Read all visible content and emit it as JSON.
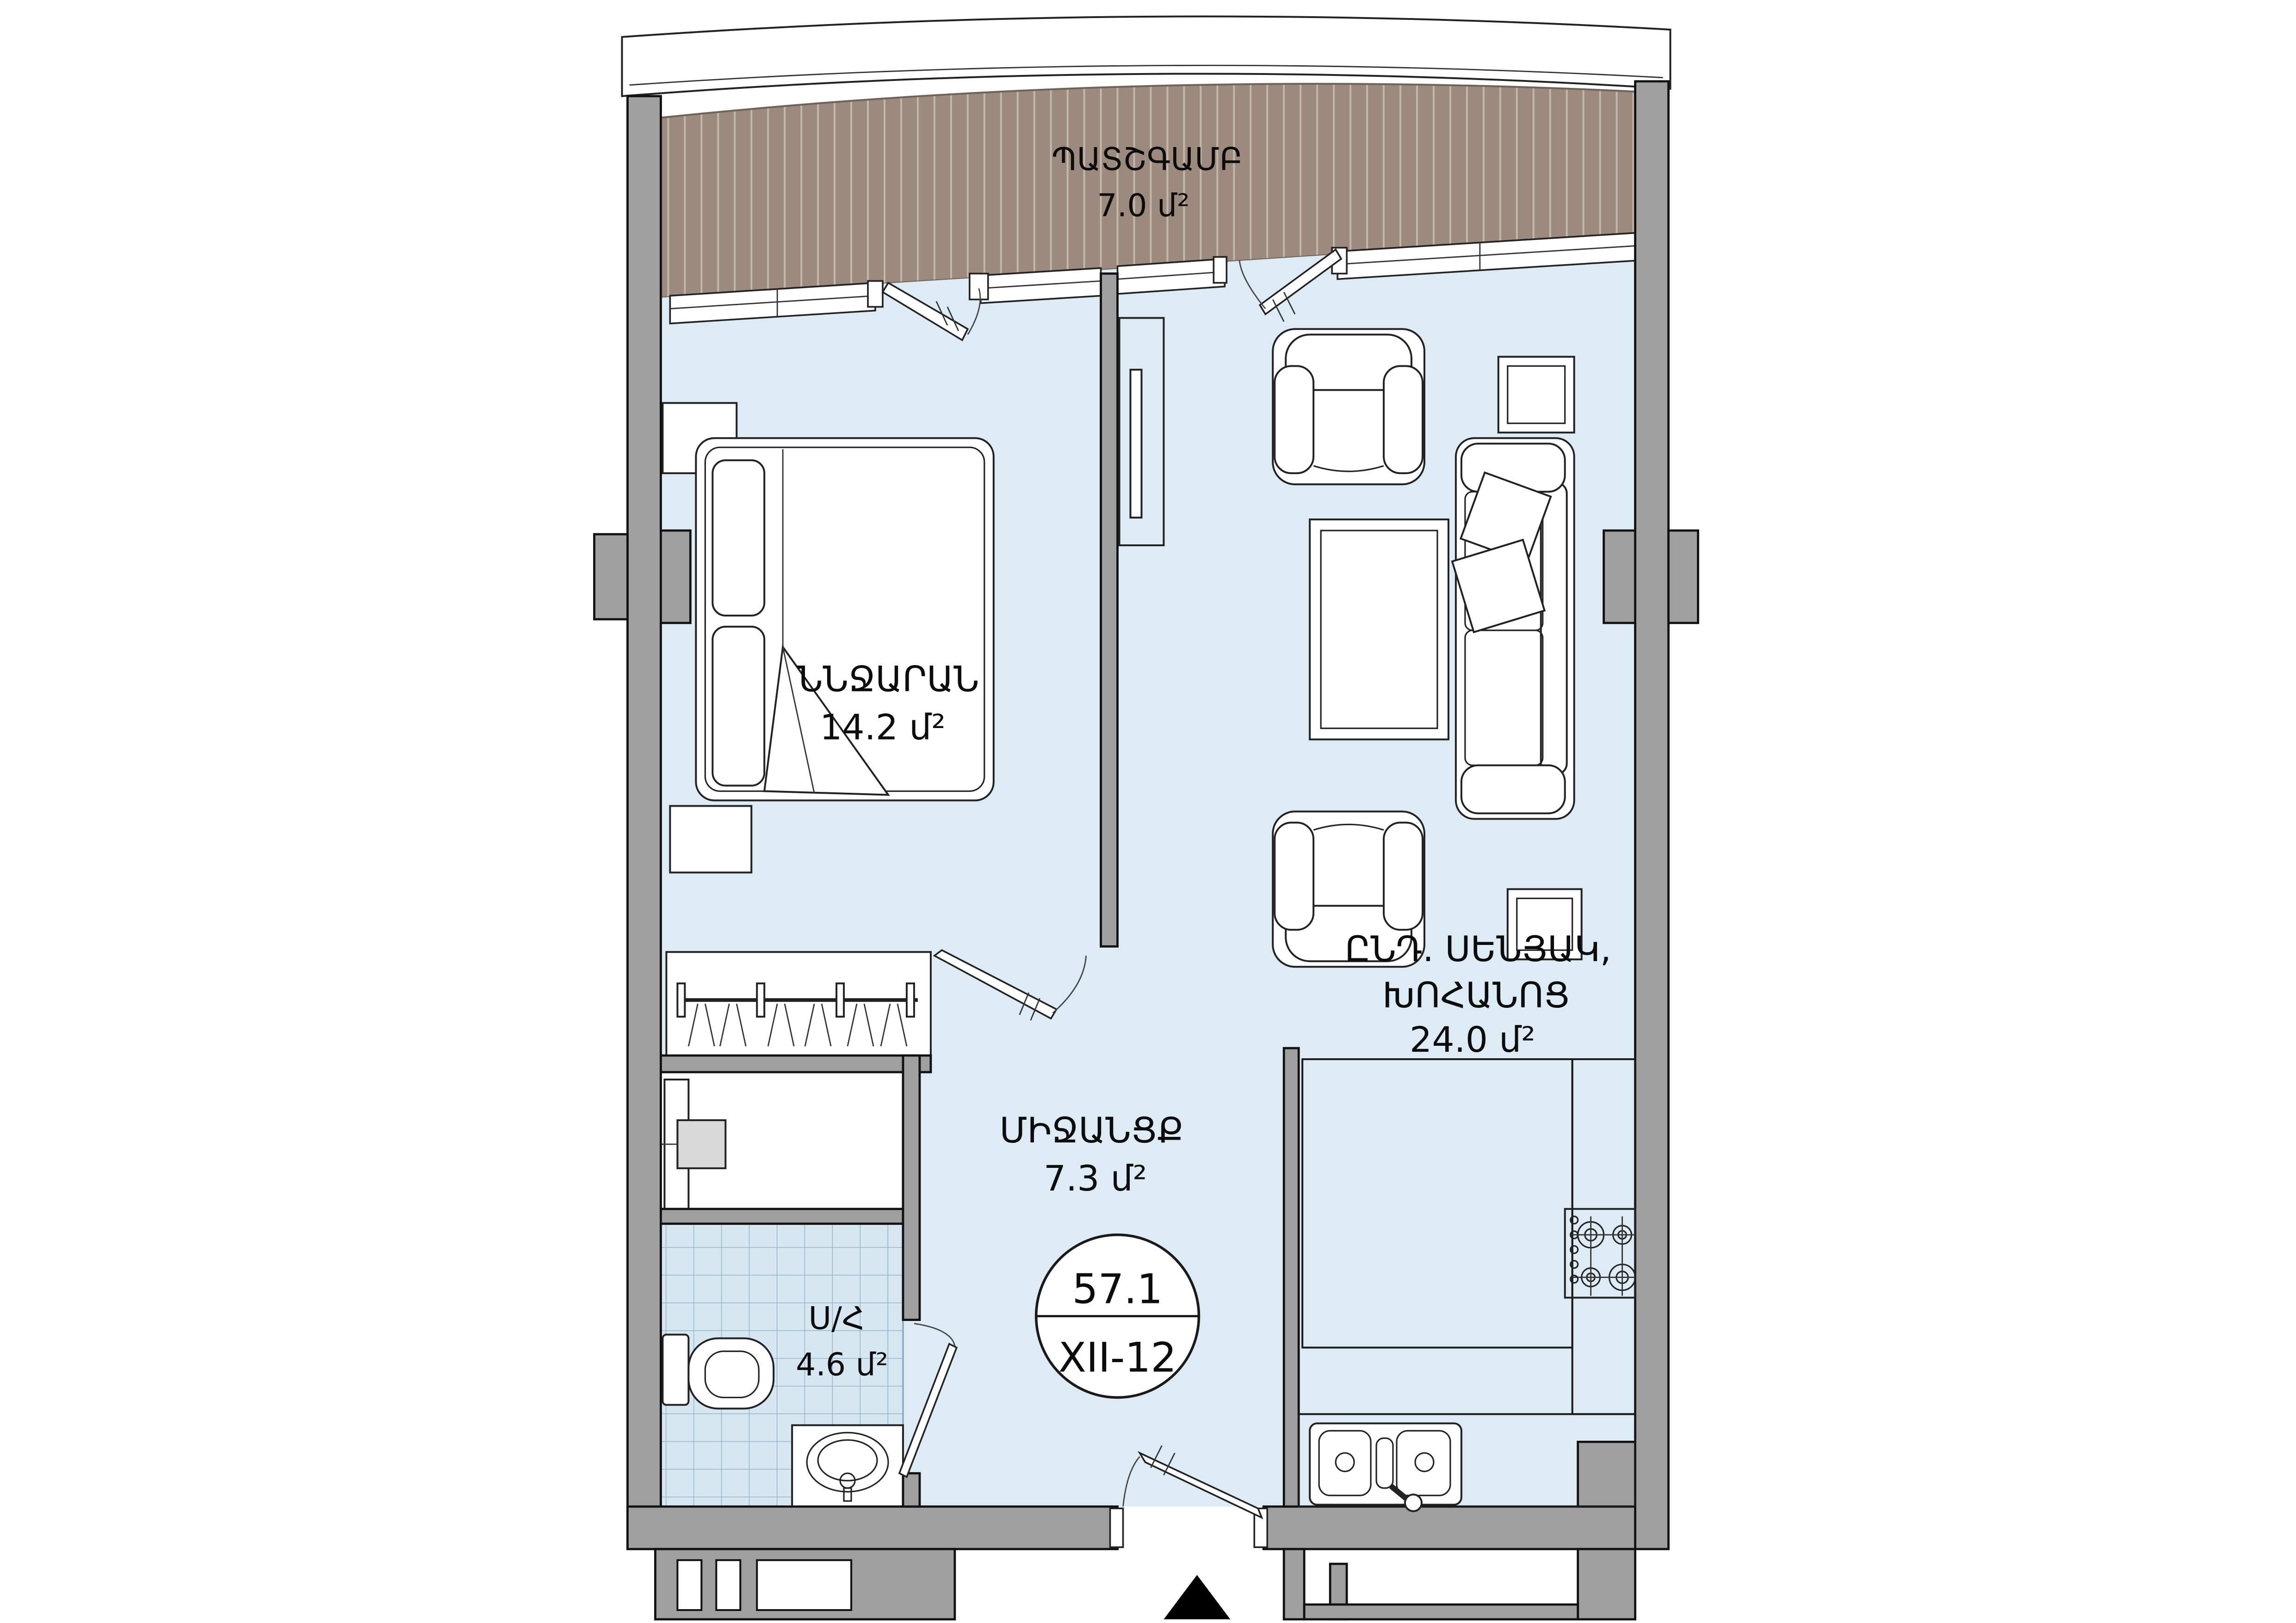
{
  "rooms": {
    "balcony": {
      "name": "ՊԱՏՇԳԱՄԲ",
      "area": "7.0 մ²"
    },
    "bedroom": {
      "name": "ՆՆՋԱՐԱՆ",
      "area": "14.2 մ²"
    },
    "living": {
      "name_line_1": "ԸՆԴ. ՍԵՆՅԱԿ,",
      "name_line_2": "ԽՈՀԱՆՈՑ",
      "area": "24.0 մ²"
    },
    "hallway": {
      "name": "ՄԻՋԱՆՑՔ",
      "area": "7.3 մ²"
    },
    "bathroom": {
      "name": "Ս/Հ",
      "area": "4.6 մ²"
    }
  },
  "unit_badge": {
    "total_area": "57.1",
    "unit_code": "XII-12"
  },
  "colors": {
    "floor": "#dcebf4",
    "deck": "#9b8a7d",
    "deck_stripe": "#c3b7ac",
    "wall": "#9f9f9f",
    "facade": "#ffffff",
    "tile_grid": "#8fb0c4"
  }
}
